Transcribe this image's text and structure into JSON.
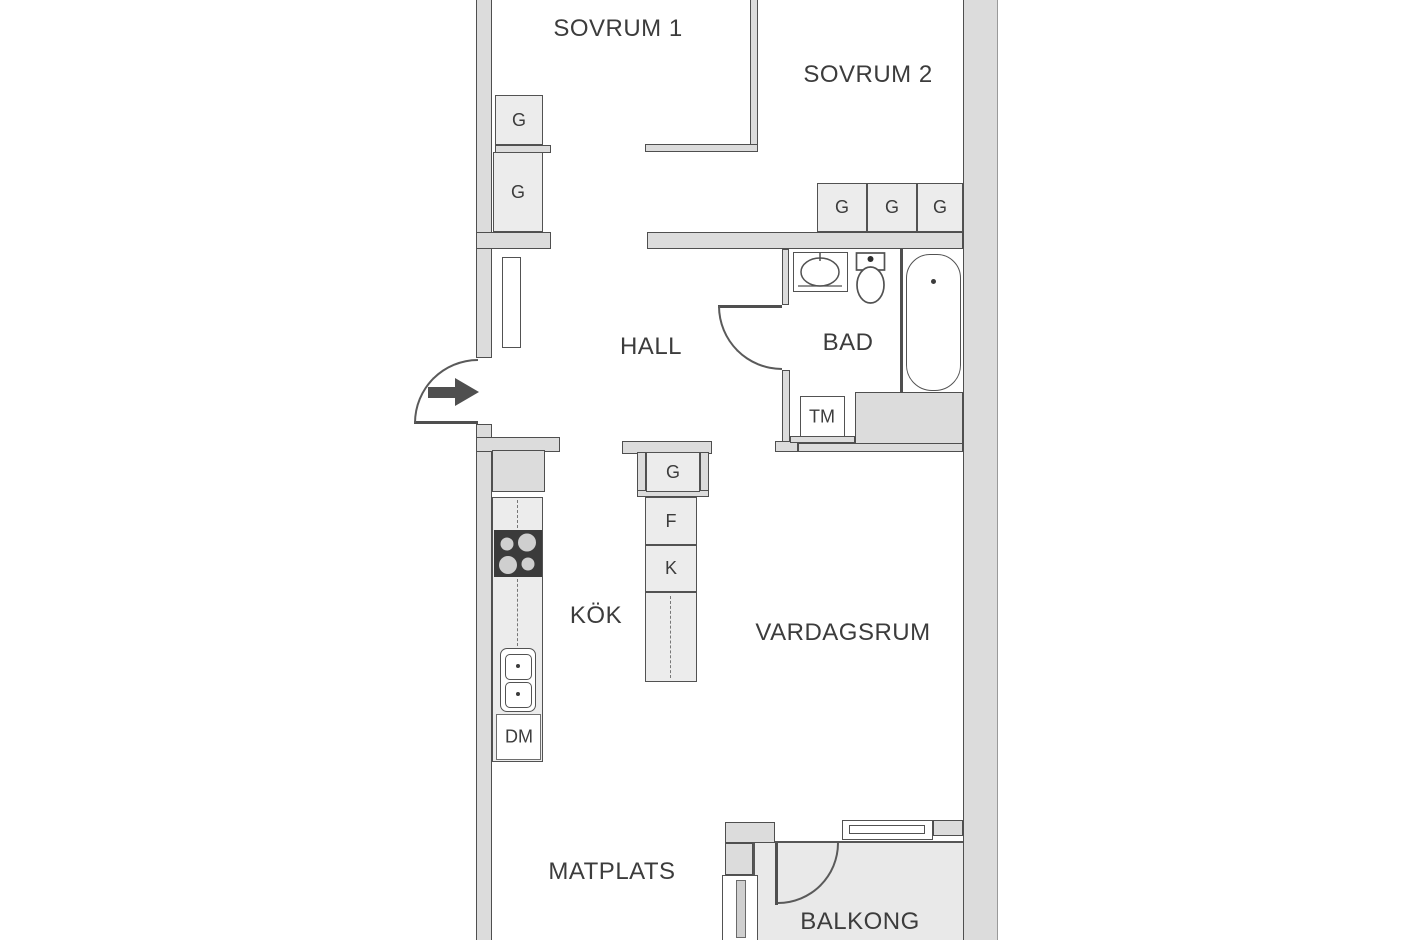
{
  "floorplan": {
    "rooms": {
      "sovrum1": "SOVRUM 1",
      "sovrum2": "SOVRUM 2",
      "hall": "HALL",
      "bad": "BAD",
      "kok": "KÖK",
      "vardagsrum": "VARDAGSRUM",
      "matplats": "MATPLATS",
      "balkong": "BALKONG"
    },
    "fixtures": {
      "wardrobe": "G",
      "freezer": "F",
      "fridge": "K",
      "washing_machine": "TM",
      "dishwasher": "DM"
    },
    "colors": {
      "wall_fill": "#dcdcdc",
      "wall_line": "#4f4f4f",
      "closet_fill": "#ececec",
      "floor": "#ffffff",
      "balcony_floor": "#e9e9e9",
      "stove": "#3b3b3b",
      "text": "#3c3c3c"
    }
  }
}
